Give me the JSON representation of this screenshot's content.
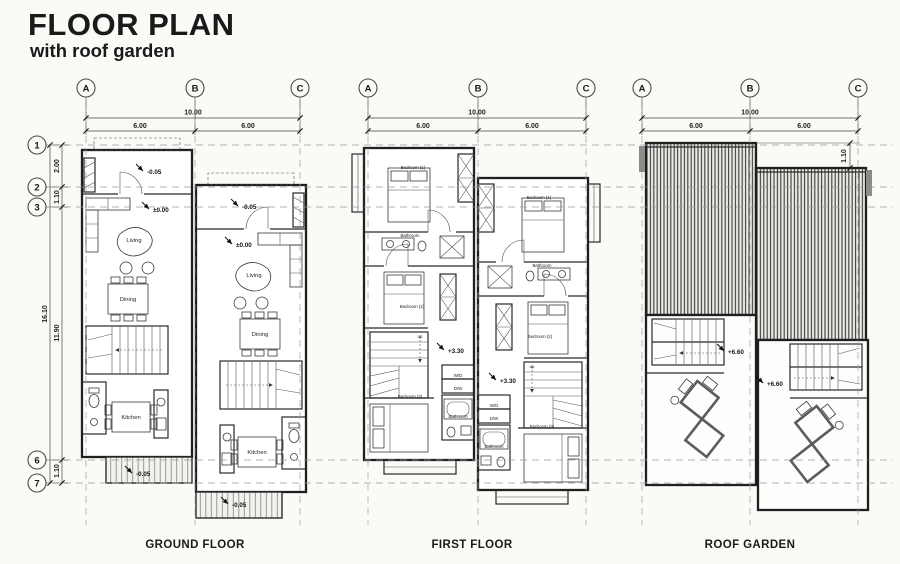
{
  "title": {
    "main": "FLOOR PLAN",
    "subtitle": "with roof garden"
  },
  "plans": {
    "ground": {
      "caption": "GROUND FLOOR"
    },
    "first": {
      "caption": "FIRST FLOOR"
    },
    "roof": {
      "caption": "ROOF GARDEN"
    }
  },
  "grid": {
    "cols": [
      "A",
      "B",
      "C"
    ],
    "rows": [
      "1",
      "2",
      "3",
      "6",
      "7"
    ]
  },
  "dims": {
    "total_width": "10.00",
    "bay_left": "6.00",
    "bay_right": "6.00",
    "total_height": "16.10",
    "row_1_2": "2.00",
    "row_2_3": "1.10",
    "row_3_6": "11.90",
    "row_6_7": "1.10",
    "roof_offset": "1.10"
  },
  "levels": {
    "deck": "-0.05",
    "ground": "±0.00",
    "first": "+3.30",
    "roof": "+6.60"
  },
  "rooms": {
    "living": "Living",
    "dining": "Dining",
    "kitchen": "Kitchen",
    "bedroom1": "Bedroom (1)",
    "bedroom2": "Bedroom (2)",
    "bedroom3": "Bedroom (3)",
    "bathroom": "Bathroom",
    "laundry_wd": "W/D",
    "laundry_dw": "D/W",
    "up": "up"
  },
  "colors": {
    "ink": "#1c1c1c",
    "paper": "#fbfaf7",
    "grid_line": "#9a9a9a",
    "roof_stripe": "#3f3f3f",
    "accent_gray": "#8a8a8a"
  }
}
